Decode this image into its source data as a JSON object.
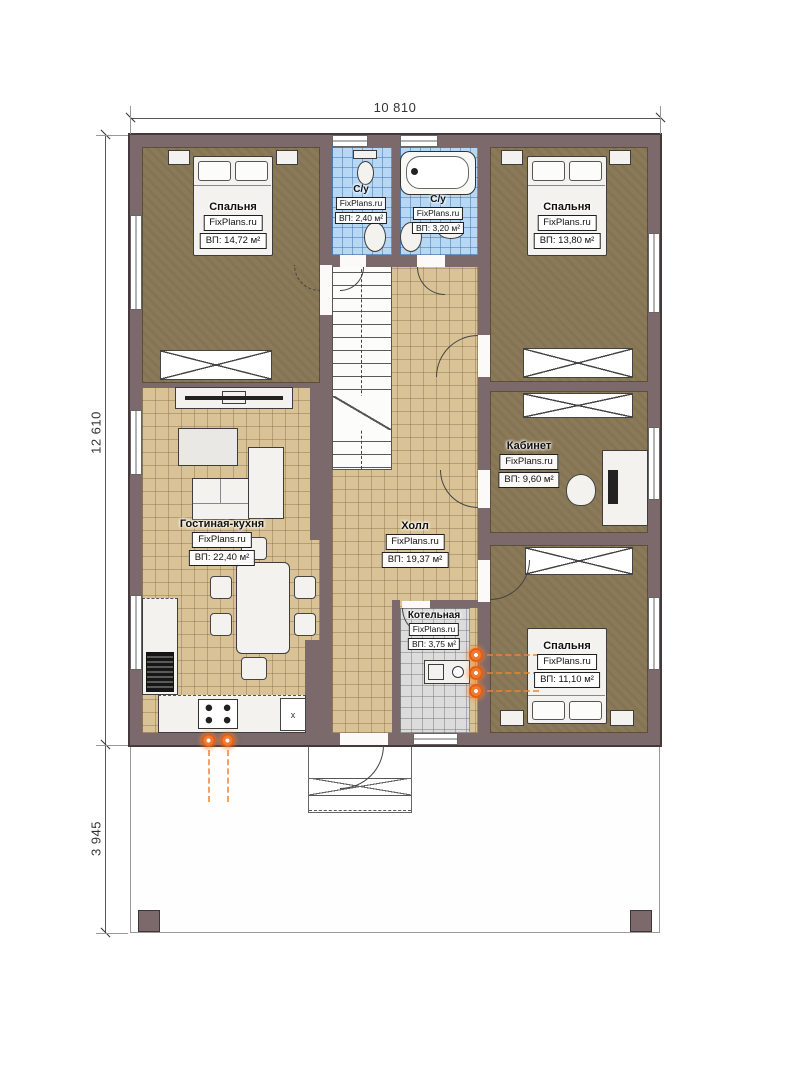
{
  "plan": {
    "brand": "FixPlans.ru",
    "dimensions": {
      "width_total": "10 810",
      "height_main": "12 610",
      "height_terrace": "3 945"
    },
    "rooms": [
      {
        "id": "bedroom-top-left",
        "name": "Спальня",
        "watermark": "FixPlans.ru",
        "area": "ВП: 14,72 м²"
      },
      {
        "id": "bathroom-left",
        "name": "С/у",
        "watermark": "FixPlans.ru",
        "area": "ВП: 2,40 м²"
      },
      {
        "id": "bathroom-right",
        "name": "С/у",
        "watermark": "FixPlans.ru",
        "area": "ВП: 3,20 м²"
      },
      {
        "id": "bedroom-top-right",
        "name": "Спальня",
        "watermark": "FixPlans.ru",
        "area": "ВП: 13,80 м²"
      },
      {
        "id": "living-kitchen",
        "name": "Гостиная-кухня",
        "watermark": "FixPlans.ru",
        "area": "ВП: 22,40 м²"
      },
      {
        "id": "hall",
        "name": "Холл",
        "watermark": "FixPlans.ru",
        "area": "ВП: 19,37 м²"
      },
      {
        "id": "office",
        "name": "Кабинет",
        "watermark": "FixPlans.ru",
        "area": "ВП: 9,60 м²"
      },
      {
        "id": "boiler-room",
        "name": "Котельная",
        "watermark": "FixPlans.ru",
        "area": "ВП: 3,75 м²"
      },
      {
        "id": "bedroom-bottom-right",
        "name": "Спальня",
        "watermark": "FixPlans.ru",
        "area": "ВП: 11,10 м²"
      }
    ],
    "appliance_marker": "x",
    "colors": {
      "wall": "#7c696b",
      "bedroom_floor": "#8b7a58",
      "tile_tan": "#d9c396",
      "tile_blue": "#b6d8f4",
      "tile_gray": "#dcdcdc",
      "radiator_accent": "#f07a30"
    }
  }
}
